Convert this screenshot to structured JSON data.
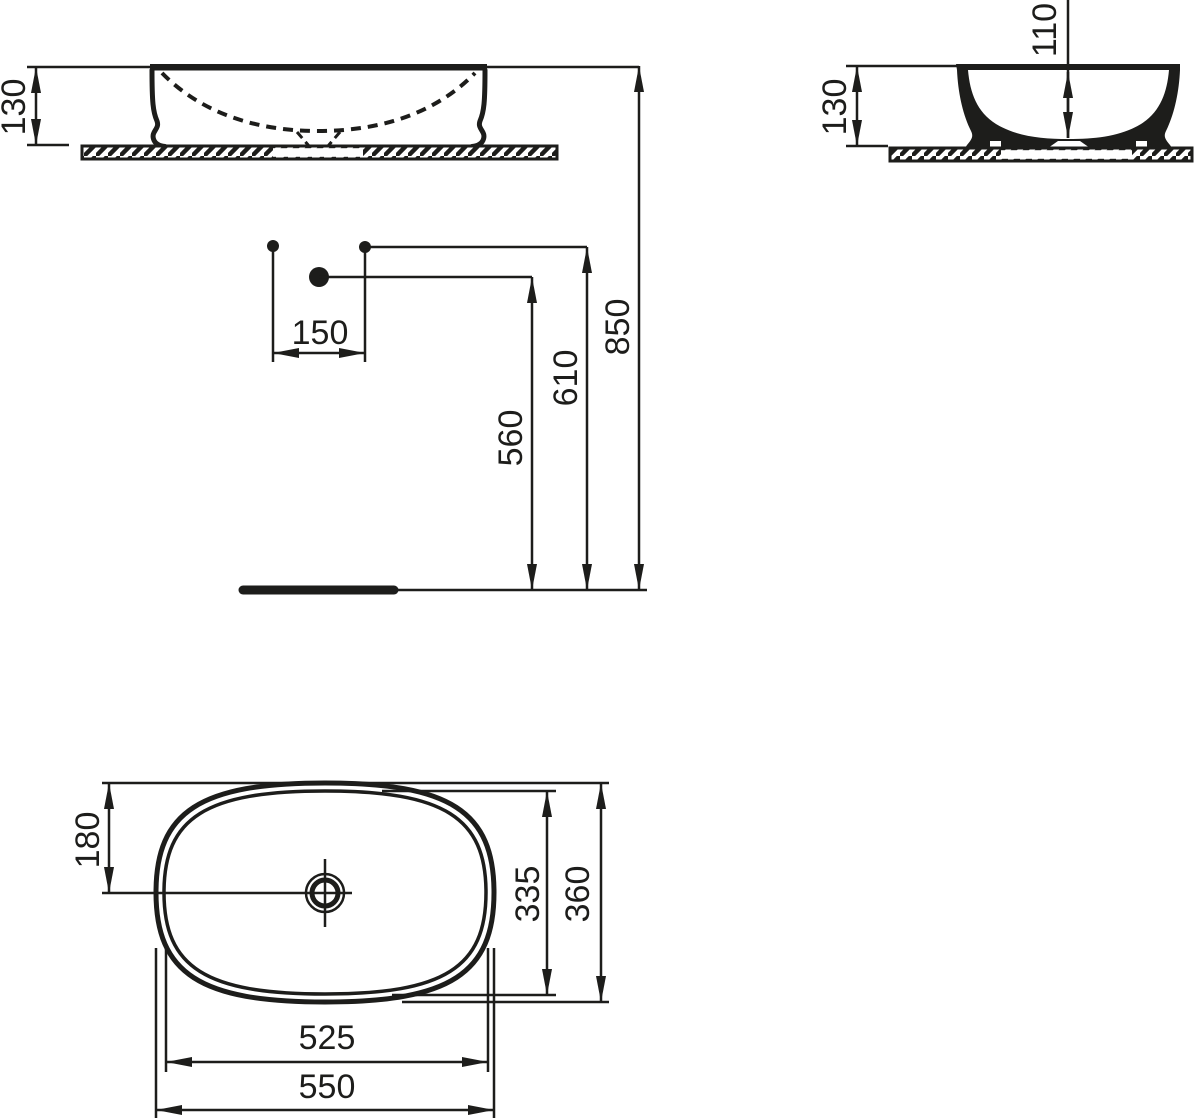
{
  "drawing": {
    "kind": "washbasin-technical-dimension-drawing",
    "units": "mm"
  },
  "colors": {
    "ink": "#1d1d1b",
    "background": "#ffffff"
  },
  "labels": {
    "front_view": {
      "basin_height": "130",
      "tap_hole_spacing": "150",
      "drain_outlet_height": "560",
      "tap_hole_height": "610",
      "rim_height_from_floor": "850"
    },
    "side_view": {
      "basin_height": "130",
      "basin_inner_depth": "110"
    },
    "top_view": {
      "rim_to_drain_center": "180",
      "inner_basin_width": "335",
      "overall_width": "360",
      "inner_basin_length": "525",
      "overall_length": "550"
    }
  }
}
